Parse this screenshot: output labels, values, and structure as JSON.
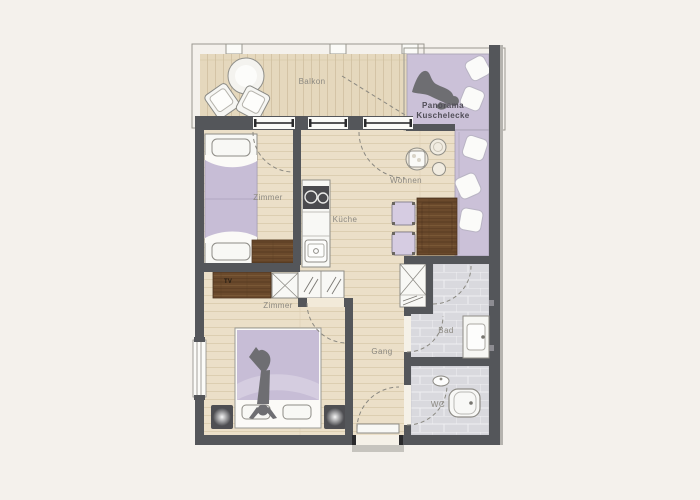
{
  "floorplan": {
    "title": "Apartment floor plan",
    "rooms": [
      {
        "id": "balkon",
        "label": "Balkon"
      },
      {
        "id": "panorama-kuschelecke",
        "label_line1": "Panorama",
        "label_line2": "Kuschelecke"
      },
      {
        "id": "zimmer-upper",
        "label": "Zimmer"
      },
      {
        "id": "kueche",
        "label": "Küche"
      },
      {
        "id": "wohnen",
        "label": "Wohnen"
      },
      {
        "id": "zimmer-lower",
        "label": "Zimmer"
      },
      {
        "id": "gang",
        "label": "Gang"
      },
      {
        "id": "bad",
        "label": "Bad"
      },
      {
        "id": "wc",
        "label": "WC"
      }
    ],
    "furniture": {
      "tv_label": "TV"
    },
    "colors": {
      "background": "#f4f1ec",
      "wall": "#54565a",
      "wood_floor": "#ebdfc8",
      "balcony_floor": "#e5d8bd",
      "accent_lavender": "#cbc1d8",
      "dark_wood": "#6b4a2c",
      "tile": "#d9d9de",
      "silhouette": "#6e6e72"
    }
  }
}
